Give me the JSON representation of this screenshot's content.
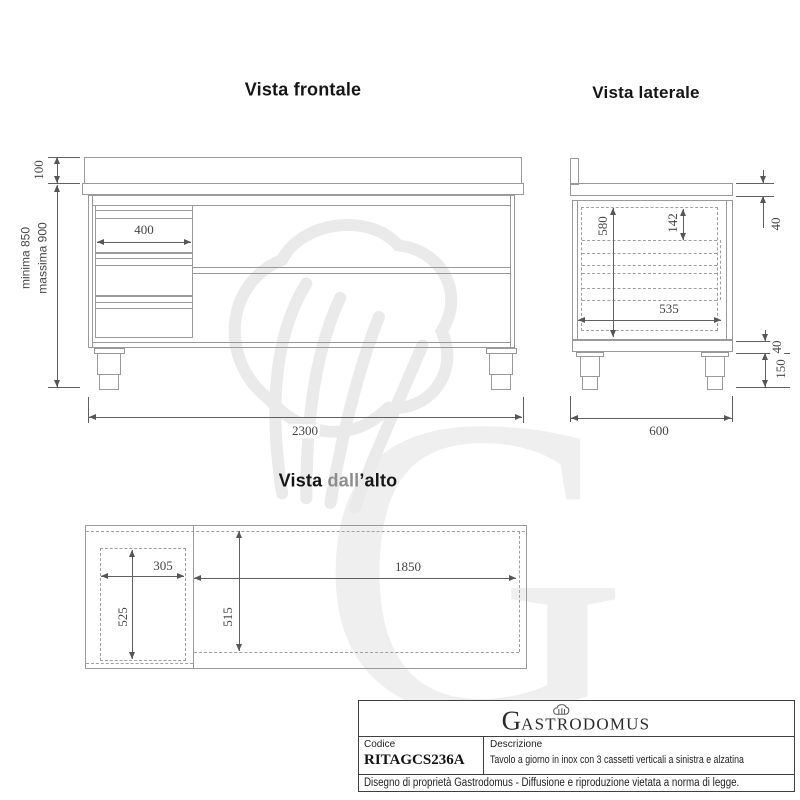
{
  "colors": {
    "drawing_line": "#9a9a9a",
    "dimension_line": "#606060",
    "dimension_text": "#474747",
    "title_text": "#161616",
    "title_gray_word": "#8d8d8d",
    "watermark": "#efefef",
    "title_block_border": "#3f3f3f"
  },
  "titles": {
    "front_view": "Vista frontale",
    "side_view": "Vista laterale",
    "top_view_part1": "Vista ",
    "top_view_part2": "dall",
    "top_view_part3": "’alto"
  },
  "front_view": {
    "dims": {
      "upstand_height": "100",
      "height_min": "minima 850",
      "height_max": "massima 900",
      "drawer_width": "400",
      "overall_width": "2300"
    }
  },
  "side_view": {
    "dims": {
      "upstand_top": "40",
      "clear_height": "580",
      "drawer_front_height": "142",
      "clear_depth": "535",
      "base_frame": "40",
      "leg_height": "150",
      "overall_depth": "600"
    }
  },
  "top_view": {
    "dims": {
      "drawer_block_width": "305",
      "open_width": "1850",
      "drawer_block_depth": "525",
      "open_depth": "515"
    }
  },
  "watermark": {
    "letter": "G"
  },
  "title_block": {
    "logo_initial": "G",
    "logo_rest": "ASTRODOMUS",
    "code_label": "Codice",
    "code_value": "RITAGCS236A",
    "description_label": "Descrizione",
    "description_value": "Tavolo a giorno in inox con 3 cassetti verticali a sinistra e alzatina",
    "legal_note": "Disegno di proprietà Gastrodomus -  Diffusione e riproduzione vietata a norma di legge."
  }
}
